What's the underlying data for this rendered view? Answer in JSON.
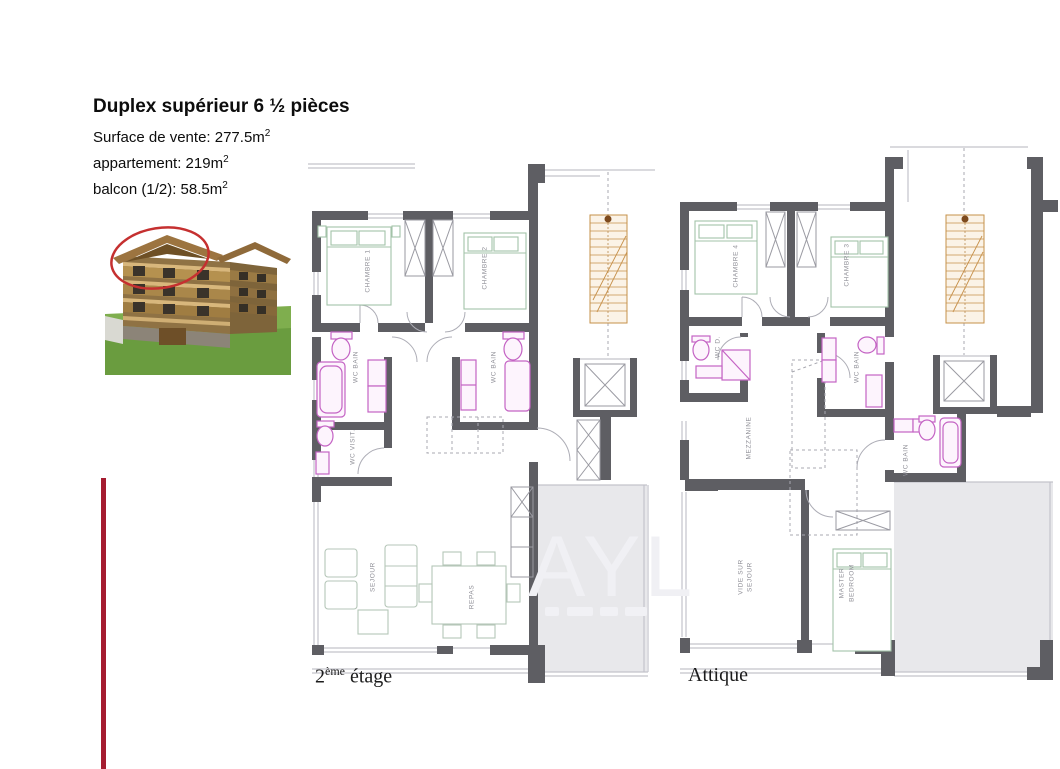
{
  "header": {
    "title": "Duplex supérieur 6 ½ pièces",
    "area_lines": [
      {
        "text": "Surface de vente: 277.5m",
        "sup": "2"
      },
      {
        "text": "appartement: 219m",
        "sup": "2"
      },
      {
        "text": "balcon (1/2): 58.5m",
        "sup": "2"
      }
    ]
  },
  "watermark": {
    "letters": "AYL"
  },
  "floorplans": {
    "left": {
      "caption_base": "2",
      "caption_sup": "ème",
      "caption_rest": " étage",
      "rooms": {
        "c1": "CHAMBRE 1",
        "c2": "CHAMBRE 2",
        "wb_left": "WC BAIN",
        "wb_right": "WC BAIN",
        "wcv": "WC VISIT.",
        "sejour": "SEJOUR",
        "repas": "REPAS"
      }
    },
    "right": {
      "caption": "Attique",
      "rooms": {
        "c4": "CHAMBRE 4",
        "c3": "CHAMBRE 3",
        "wcd": "WC D.",
        "wb_top": "WC BAIN",
        "mezz": "MEZZANINE",
        "vide1": "VIDE SUR",
        "vide2": "SEJOUR",
        "master1": "MASTER",
        "master2": "BEDROOM",
        "wb_low": "WC BAIN"
      }
    }
  },
  "colors": {
    "wall": "#5e5e63",
    "accent_red": "#a51c30",
    "fixture_pink": "#c463c4",
    "bed_green": "#a3c3a8",
    "stair_orange": "#c6904a",
    "balcony_gray": "#e8e8eb",
    "highlight_ellipse": "#c53030"
  }
}
